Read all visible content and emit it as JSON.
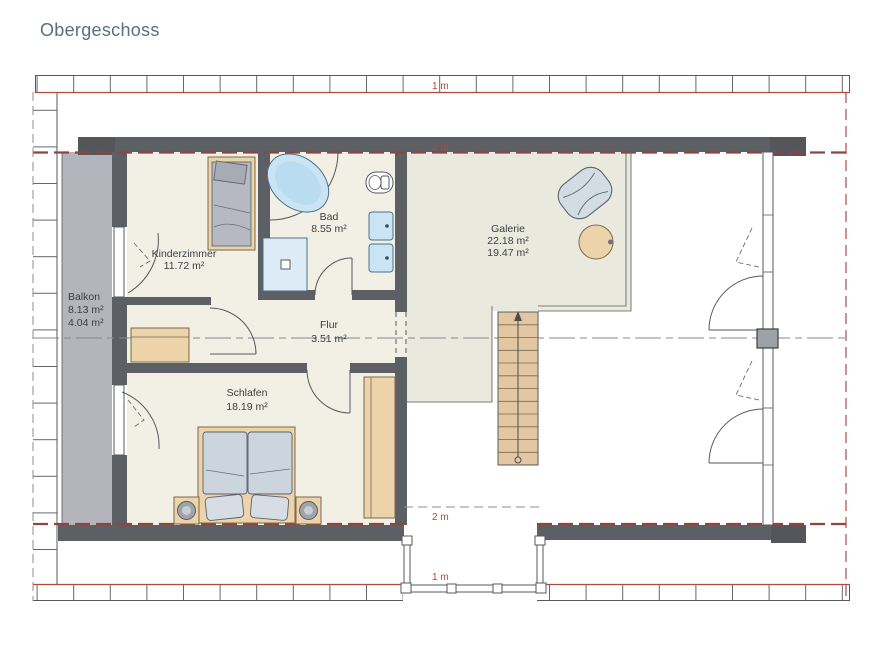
{
  "title": "Obergeschoss",
  "rooms": [
    {
      "name": "Balkon",
      "line2": "8.13 m²",
      "line3": "4.04 m²"
    },
    {
      "name": "Kinderzimmer",
      "line2": "11.72 m²"
    },
    {
      "name": "Bad",
      "line2": "8.55 m²"
    },
    {
      "name": "Galerie",
      "line2": "22.18 m²",
      "line3": "19.47 m²"
    },
    {
      "name": "Flur",
      "line2": "3.51 m²"
    },
    {
      "name": "Schlafen",
      "line2": "18.19 m²"
    }
  ],
  "dimensions": {
    "eave_top": "1 m",
    "wall_top": "2 m",
    "wall_bottom": "2 m",
    "eave_bottom": "1 m"
  },
  "colors": {
    "accent_red": "#b0493f",
    "red_dark": "#8f453e",
    "wall": "#5c5f64",
    "wall_dark": "#54565b",
    "line": "#55585c",
    "tick": "#63666a",
    "floor": "#f2f0e4",
    "floor_galerie": "#e9eadd",
    "balcony": "#b4b5bc",
    "wood": "#ecd3aa",
    "wood_line": "#7a6a4e",
    "stairs": "#e3c7a2",
    "mattress": "#b6b9c1",
    "bedding": "#ccd4dd",
    "water_blue": "#cbe4f3",
    "fixture_line": "#49708c",
    "text": "#3b3e44",
    "title_color": "#5a6f7e",
    "center_line": "#85888c"
  }
}
